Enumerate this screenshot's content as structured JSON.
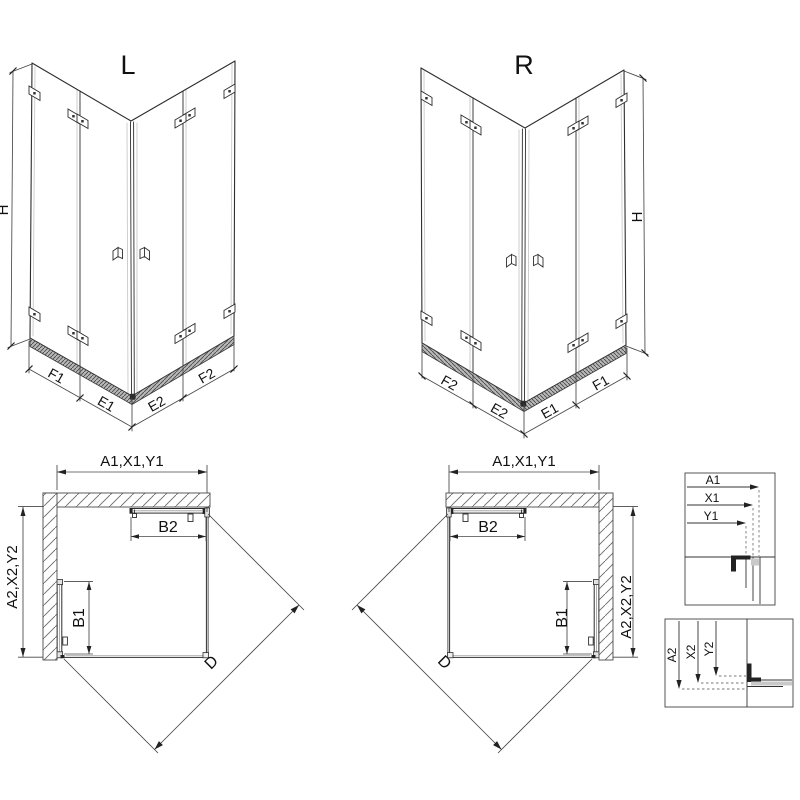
{
  "colors": {
    "background": "#ffffff",
    "line": "#2d2d2d",
    "dim_line": "#474747",
    "tick": "#222222",
    "wall_hatch": "#6a6a6a",
    "sill_fill": "#b8b8b8",
    "glass_shade": "#c9c9c9",
    "dark_fill": "#222222"
  },
  "views": {
    "iso_left": {
      "label": "L",
      "height_label": "H",
      "bottom_labels": [
        "F1",
        "E1",
        "E2",
        "F2"
      ]
    },
    "iso_right": {
      "label": "R",
      "height_label": "H",
      "bottom_labels": [
        "F2",
        "E2",
        "E1",
        "F1"
      ]
    },
    "plan_left": {
      "width_label": "A1,X1,Y1",
      "depth_label": "A2,X2,Y2",
      "door_top_label": "B2",
      "door_side_label": "B1",
      "diagonal_label": "D"
    },
    "plan_right": {
      "width_label": "A1,X1,Y1",
      "depth_label": "A2,X2,Y2",
      "door_top_label": "B2",
      "door_side_label": "B1",
      "diagonal_label": "D"
    },
    "detail_width": {
      "labels": [
        "A1",
        "X1",
        "Y1"
      ]
    },
    "detail_depth": {
      "labels": [
        "A2",
        "X2",
        "Y2"
      ]
    }
  }
}
